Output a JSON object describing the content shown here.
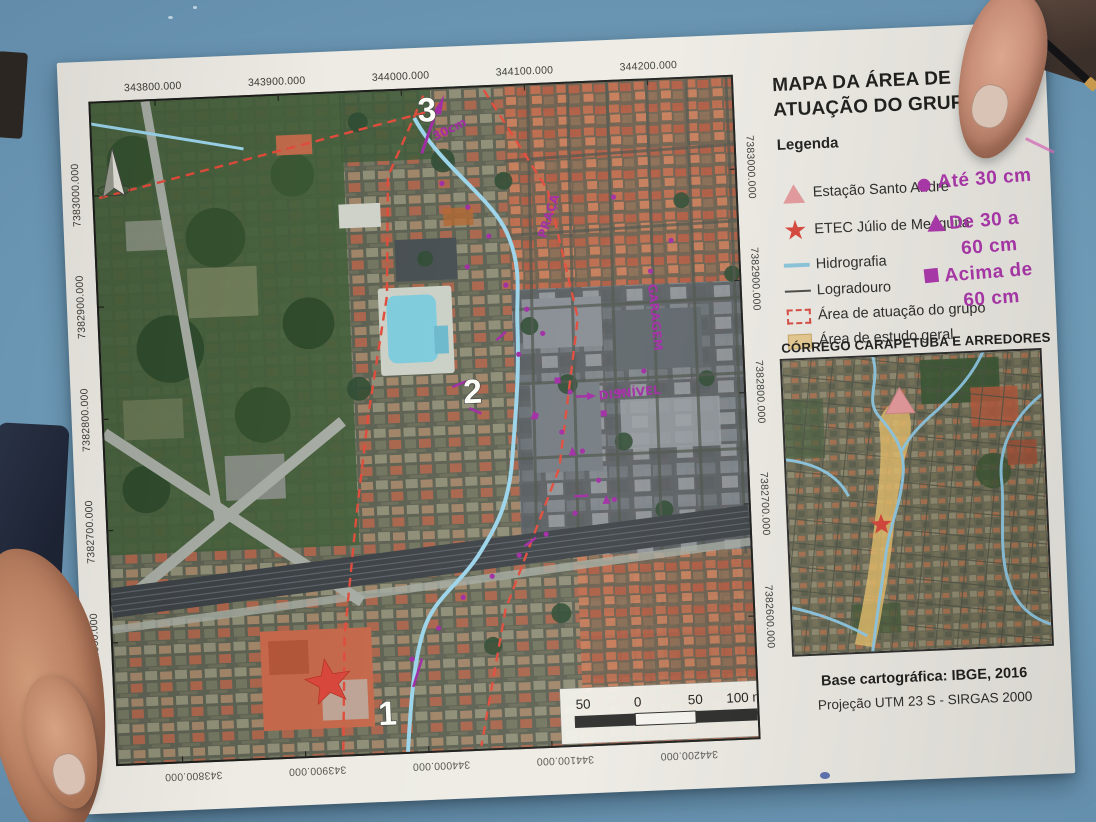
{
  "map_sheet": {
    "title": "MAPA DA ÁREA DE ATUAÇÃO DO GRUPO 2",
    "legend": {
      "heading": "Legenda",
      "items": [
        {
          "symbol": "pink-triangle",
          "label": "Estação Santo André"
        },
        {
          "symbol": "red-star",
          "label": "ETEC Júlio de Mesquita"
        },
        {
          "symbol": "blue-line",
          "label": "Hidrografia"
        },
        {
          "symbol": "black-line",
          "label": "Logradouro"
        },
        {
          "symbol": "red-dashed-rect",
          "label": "Área de atuação do grupo"
        },
        {
          "symbol": "tan-rect",
          "label": "Área de estudo geral"
        }
      ]
    },
    "handwritten_legend": {
      "color": "#ad36ad",
      "items": [
        {
          "symbol": "dot",
          "line1": "Até 30 cm",
          "line2": ""
        },
        {
          "symbol": "triangle",
          "line1": "De 30 a",
          "line2": "60 cm"
        },
        {
          "symbol": "square",
          "line1": "Acima de",
          "line2": "60 cm"
        }
      ]
    },
    "inset": {
      "title": "CÓRREGO CARAPETUBA E ARREDORES"
    },
    "credits": {
      "base": "Base cartográfica: IBGE, 2016",
      "projection": "Projeção UTM 23 S - SIRGAS 2000"
    },
    "grid": {
      "x_labels": [
        "343800.000",
        "343900.000",
        "344000.000",
        "344100.000",
        "344200.000"
      ],
      "y_labels": [
        "7383000.000",
        "7382900.000",
        "7382800.000",
        "7382700.000",
        "7382600.000"
      ]
    },
    "scale_bar": {
      "labels": [
        "50",
        "0",
        "50",
        "100 m"
      ]
    },
    "map_annotations": {
      "point_labels": [
        "1",
        "2",
        "3"
      ],
      "handwriting": [
        "DISNÍVEL",
        "GARAGEM",
        "PRAÇA",
        "30cm"
      ]
    }
  }
}
